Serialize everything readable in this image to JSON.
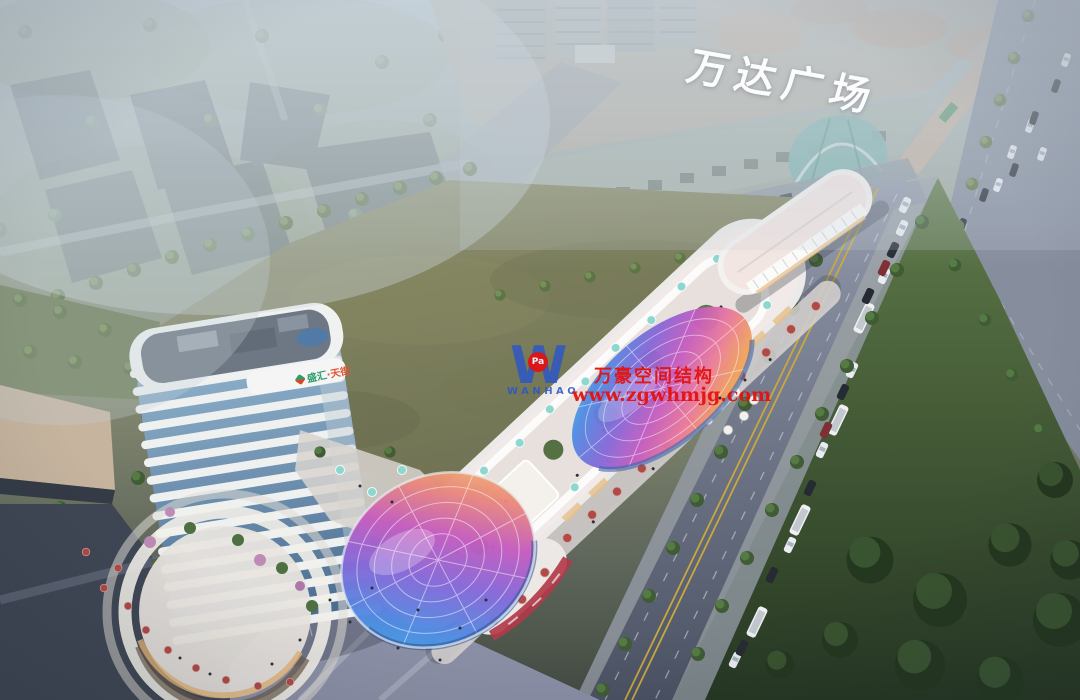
{
  "scene": {
    "type": "aerial dusk architectural rendering of a mixed-use retail complex",
    "mall_sign": "万达广场",
    "tower_sign": {
      "brand": "盛汇",
      "suffix": "·天街"
    }
  },
  "watermark": {
    "logo_letter": "W",
    "logo_badge": "Pa",
    "logo_name": "WANHAO",
    "company_cn": "万豪空间结构",
    "website": "www.zgwhmjg.com"
  },
  "palette": {
    "watermark_red": "#e41210",
    "watermark_blue": "#2b55c8",
    "field_olive": "#7e8160",
    "park_green": "#2e4227",
    "tower_glass": "#5d82a8",
    "building_white": "#efeeec",
    "lane_yellow": "#c9a83e",
    "umbrella_teal": "#8fd6ce",
    "umbrella_red": "#b04a48",
    "led_red": "#b23a4a",
    "haze": "#c9d4de",
    "canopy_iridescent_1": "#58c8ea",
    "canopy_iridescent_2": "#4f8ce2",
    "canopy_iridescent_3": "#8668d8",
    "canopy_iridescent_4": "#c45cc0",
    "canopy_iridescent_5": "#ea7a9a",
    "canopy_iridescent_6": "#f0a25e",
    "canopy_iridescent_7": "#f3d66a"
  }
}
